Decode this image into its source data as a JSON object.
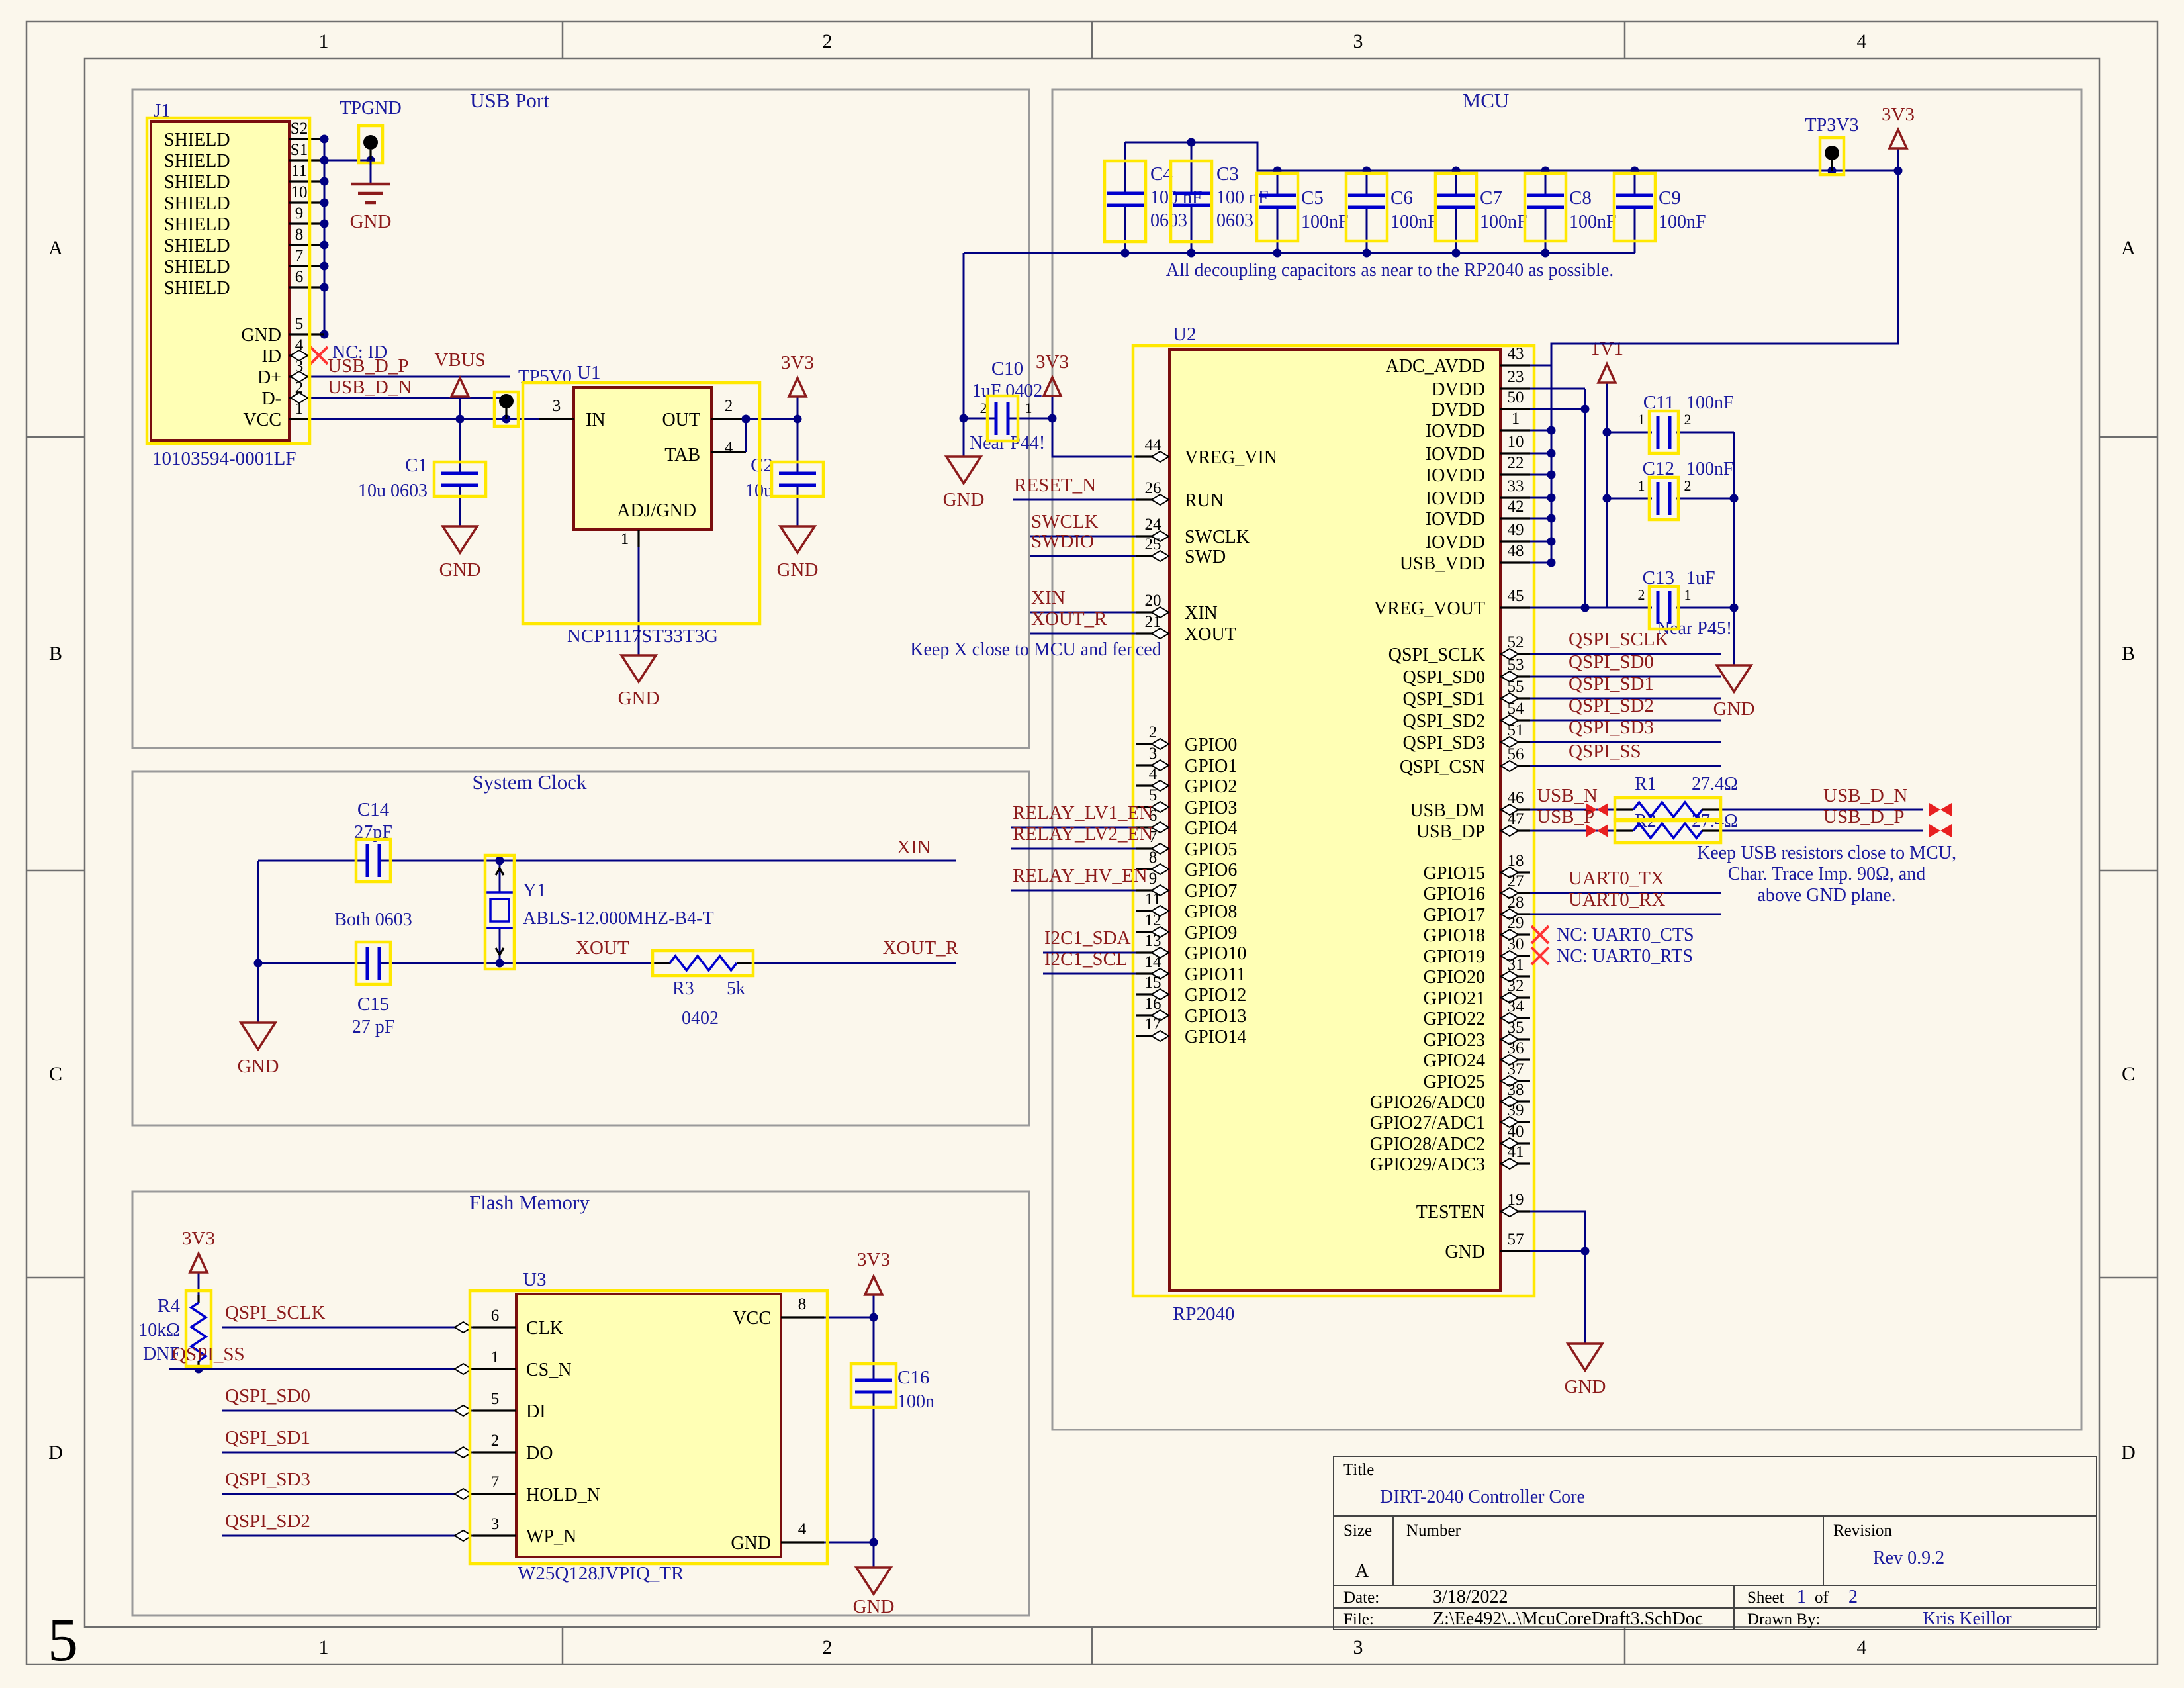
{
  "sheet": {
    "page_number": "5",
    "columns": [
      "1",
      "2",
      "3",
      "4"
    ],
    "rows": [
      "A",
      "B",
      "C",
      "D"
    ]
  },
  "sections": {
    "usb_port": "USB Port",
    "system_clock": "System Clock",
    "flash_memory": "Flash Memory",
    "mcu": "MCU"
  },
  "usb_port": {
    "j1": {
      "ref": "J1",
      "part_number": "10103594-0001LF",
      "shield_pins": [
        {
          "num": "S2",
          "name": "SHIELD"
        },
        {
          "num": "S1",
          "name": "SHIELD"
        },
        {
          "num": "11",
          "name": "SHIELD"
        },
        {
          "num": "10",
          "name": "SHIELD"
        },
        {
          "num": "9",
          "name": "SHIELD"
        },
        {
          "num": "8",
          "name": "SHIELD"
        },
        {
          "num": "7",
          "name": "SHIELD"
        },
        {
          "num": "6",
          "name": "SHIELD"
        }
      ],
      "signal_pins": [
        {
          "num": "5",
          "name": "GND"
        },
        {
          "num": "4",
          "name": "ID",
          "nc": "NC: ID"
        },
        {
          "num": "3",
          "name": "D+",
          "net": "USB_D_P"
        },
        {
          "num": "2",
          "name": "D-",
          "net": "USB_D_N"
        },
        {
          "num": "1",
          "name": "VCC"
        }
      ]
    },
    "tpgnd": {
      "label": "TPGND",
      "gnd": "GND"
    },
    "vbus": "VBUS",
    "tp5v0": "TP5V0",
    "c1": {
      "ref": "C1",
      "value": "10u 0603",
      "gnd": "GND"
    },
    "u1": {
      "ref": "U1",
      "part_number": "NCP1117ST33T3G",
      "gnd": "GND",
      "pin_in": {
        "num": "3",
        "name": "IN"
      },
      "pin_out": {
        "num": "2",
        "name": "OUT"
      },
      "pin_tab": {
        "num": "4",
        "name": "TAB"
      },
      "pin_adj": {
        "num": "1",
        "name": "ADJ/GND"
      }
    },
    "c2": {
      "ref": "C2",
      "value": "10u",
      "gnd": "GND"
    },
    "rail_3v3": "3V3"
  },
  "system_clock": {
    "c14": {
      "ref": "C14",
      "value": "27pF"
    },
    "c15": {
      "ref": "C15",
      "value": "27 pF"
    },
    "both_note": "Both 0603",
    "y1": {
      "ref": "Y1",
      "part_number": "ABLS-12.000MHZ-B4-T"
    },
    "r3": {
      "ref": "R3",
      "value": "5k",
      "size": "0402"
    },
    "net_xin": "XIN",
    "net_xout": "XOUT",
    "net_xout_r": "XOUT_R",
    "gnd": "GND"
  },
  "flash_memory": {
    "r4": {
      "ref": "R4",
      "value": "10kΩ",
      "note": "DNF",
      "rail": "3V3"
    },
    "u3": {
      "ref": "U3",
      "part_number": "W25Q128JVPIQ_TR",
      "left_pins": [
        {
          "num": "6",
          "name": "CLK",
          "net": "QSPI_SCLK"
        },
        {
          "num": "1",
          "name": "CS_N",
          "net": "QSPI_SS"
        },
        {
          "num": "5",
          "name": "DI",
          "net": "QSPI_SD0"
        },
        {
          "num": "2",
          "name": "DO",
          "net": "QSPI_SD1"
        },
        {
          "num": "7",
          "name": "HOLD_N",
          "net": "QSPI_SD3"
        },
        {
          "num": "3",
          "name": "WP_N",
          "net": "QSPI_SD2"
        }
      ],
      "pin_vcc": {
        "num": "8",
        "name": "VCC"
      },
      "pin_gnd": {
        "num": "4",
        "name": "GND"
      }
    },
    "c16": {
      "ref": "C16",
      "value": "100n"
    },
    "rail_3v3": "3V3",
    "gnd": "GND"
  },
  "mcu": {
    "u2": {
      "ref": "U2",
      "part_number": "RP2040",
      "left_ctrl_pins": [
        {
          "num": "44",
          "name": "VREG_VIN"
        },
        {
          "num": "26",
          "name": "RUN",
          "net": "RESET_N"
        },
        {
          "num": "24",
          "name": "SWCLK",
          "net": "SWCLK"
        },
        {
          "num": "25",
          "name": "SWD",
          "net": "SWDIO"
        },
        {
          "num": "20",
          "name": "XIN",
          "net": "XIN"
        },
        {
          "num": "21",
          "name": "XOUT",
          "net": "XOUT_R"
        }
      ],
      "left_gpio_pins": [
        {
          "num": "2",
          "name": "GPIO0"
        },
        {
          "num": "3",
          "name": "GPIO1"
        },
        {
          "num": "4",
          "name": "GPIO2"
        },
        {
          "num": "5",
          "name": "GPIO3"
        },
        {
          "num": "6",
          "name": "GPIO4",
          "net": "RELAY_LV1_EN"
        },
        {
          "num": "7",
          "name": "GPIO5",
          "net": "RELAY_LV2_EN"
        },
        {
          "num": "8",
          "name": "GPIO6"
        },
        {
          "num": "9",
          "name": "GPIO7",
          "net": "RELAY_HV_EN"
        },
        {
          "num": "11",
          "name": "GPIO8"
        },
        {
          "num": "12",
          "name": "GPIO9"
        },
        {
          "num": "13",
          "name": "GPIO10",
          "net": "I2C1_SDA"
        },
        {
          "num": "14",
          "name": "GPIO11",
          "net": "I2C1_SCL"
        },
        {
          "num": "15",
          "name": "GPIO12"
        },
        {
          "num": "16",
          "name": "GPIO13"
        },
        {
          "num": "17",
          "name": "GPIO14"
        }
      ],
      "right_power_pins": [
        {
          "num": "43",
          "name": "ADC_AVDD"
        },
        {
          "num": "23",
          "name": "DVDD"
        },
        {
          "num": "50",
          "name": "DVDD"
        },
        {
          "num": "1",
          "name": "IOVDD"
        },
        {
          "num": "10",
          "name": "IOVDD"
        },
        {
          "num": "22",
          "name": "IOVDD"
        },
        {
          "num": "33",
          "name": "IOVDD"
        },
        {
          "num": "42",
          "name": "IOVDD"
        },
        {
          "num": "49",
          "name": "IOVDD"
        },
        {
          "num": "48",
          "name": "USB_VDD"
        }
      ],
      "pin_vreg_vout": {
        "num": "45",
        "name": "VREG_VOUT"
      },
      "qspi_pins": [
        {
          "num": "52",
          "name": "QSPI_SCLK",
          "net": "QSPI_SCLK"
        },
        {
          "num": "53",
          "name": "QSPI_SD0",
          "net": "QSPI_SD0"
        },
        {
          "num": "55",
          "name": "QSPI_SD1",
          "net": "QSPI_SD1"
        },
        {
          "num": "54",
          "name": "QSPI_SD2",
          "net": "QSPI_SD2"
        },
        {
          "num": "51",
          "name": "QSPI_SD3",
          "net": "QSPI_SD3"
        },
        {
          "num": "56",
          "name": "QSPI_CSN",
          "net": "QSPI_SS"
        }
      ],
      "usb_pins": [
        {
          "num": "46",
          "name": "USB_DM",
          "net_near": "USB_N",
          "net_far": "USB_D_N"
        },
        {
          "num": "47",
          "name": "USB_DP",
          "net_near": "USB_P",
          "net_far": "USB_D_P"
        }
      ],
      "right_gpio_pins": [
        {
          "num": "18",
          "name": "GPIO15"
        },
        {
          "num": "27",
          "name": "GPIO16",
          "net": "UART0_TX"
        },
        {
          "num": "28",
          "name": "GPIO17",
          "net": "UART0_RX"
        },
        {
          "num": "29",
          "name": "GPIO18",
          "nc": "NC: UART0_CTS"
        },
        {
          "num": "30",
          "name": "GPIO19",
          "nc": "NC: UART0_RTS"
        },
        {
          "num": "31",
          "name": "GPIO20"
        },
        {
          "num": "32",
          "name": "GPIO21"
        },
        {
          "num": "34",
          "name": "GPIO22"
        },
        {
          "num": "35",
          "name": "GPIO23"
        },
        {
          "num": "36",
          "name": "GPIO24"
        },
        {
          "num": "37",
          "name": "GPIO25"
        },
        {
          "num": "38",
          "name": "GPIO26/ADC0"
        },
        {
          "num": "39",
          "name": "GPIO27/ADC1"
        },
        {
          "num": "40",
          "name": "GPIO28/ADC2"
        },
        {
          "num": "41",
          "name": "GPIO29/ADC3"
        }
      ],
      "pin_testen": {
        "num": "19",
        "name": "TESTEN"
      },
      "pin_gnd": {
        "num": "57",
        "name": "GND"
      }
    },
    "decoupling": {
      "caps": [
        {
          "ref": "C4",
          "value": "100 nF",
          "size": "0603"
        },
        {
          "ref": "C3",
          "value": "100 nF",
          "size": "0603"
        },
        {
          "ref": "C5",
          "value": "100nF"
        },
        {
          "ref": "C6",
          "value": "100nF"
        },
        {
          "ref": "C7",
          "value": "100nF"
        },
        {
          "ref": "C8",
          "value": "100nF"
        },
        {
          "ref": "C9",
          "value": "100nF"
        }
      ],
      "note": "All decoupling capacitors as near to the RP2040 as possible."
    },
    "tp3v3": "TP3V3",
    "rail_3v3_top": "3V3",
    "c10": {
      "ref": "C10",
      "value": "1uF 0402",
      "pin2": "2",
      "pin1": "1",
      "note": "Near P44!",
      "rail": "3V3",
      "gnd": "GND"
    },
    "core_rail": {
      "label": "1V1",
      "note": "Near P45!",
      "gnd": "GND",
      "c11": {
        "ref": "C11",
        "value": "100nF",
        "pin1": "1",
        "pin2": "2"
      },
      "c12": {
        "ref": "C12",
        "value": "100nF",
        "pin1": "1",
        "pin2": "2"
      },
      "c13": {
        "ref": "C13",
        "value": "1uF",
        "pin2": "2",
        "pin1": "1"
      }
    },
    "xtal_note": "Keep X close to MCU and fenced",
    "usb": {
      "r1": {
        "ref": "R1",
        "value": "27.4Ω"
      },
      "r2": {
        "ref": "R2",
        "value": "27.4Ω"
      },
      "note_lines": [
        "Keep USB resistors close to MCU,",
        "Char. Trace Imp. 90Ω, and",
        "above GND plane."
      ]
    },
    "gnd_bottom": "GND"
  },
  "title_block": {
    "title_label": "Title",
    "title": "DIRT-2040 Controller Core",
    "size_label": "Size",
    "size": "A",
    "number_label": "Number",
    "revision_label": "Revision",
    "revision": "Rev 0.9.2",
    "date_label": "Date:",
    "date": "3/18/2022",
    "sheet_prefix": "Sheet",
    "sheet_number": "1",
    "sheet_of": "of",
    "sheet_total": "2",
    "file_label": "File:",
    "file": "Z:\\Ee492\\..\\McuCoreDraft3.SchDoc",
    "drawn_by_label": "Drawn By:",
    "drawn_by": "Kris Keillor"
  }
}
